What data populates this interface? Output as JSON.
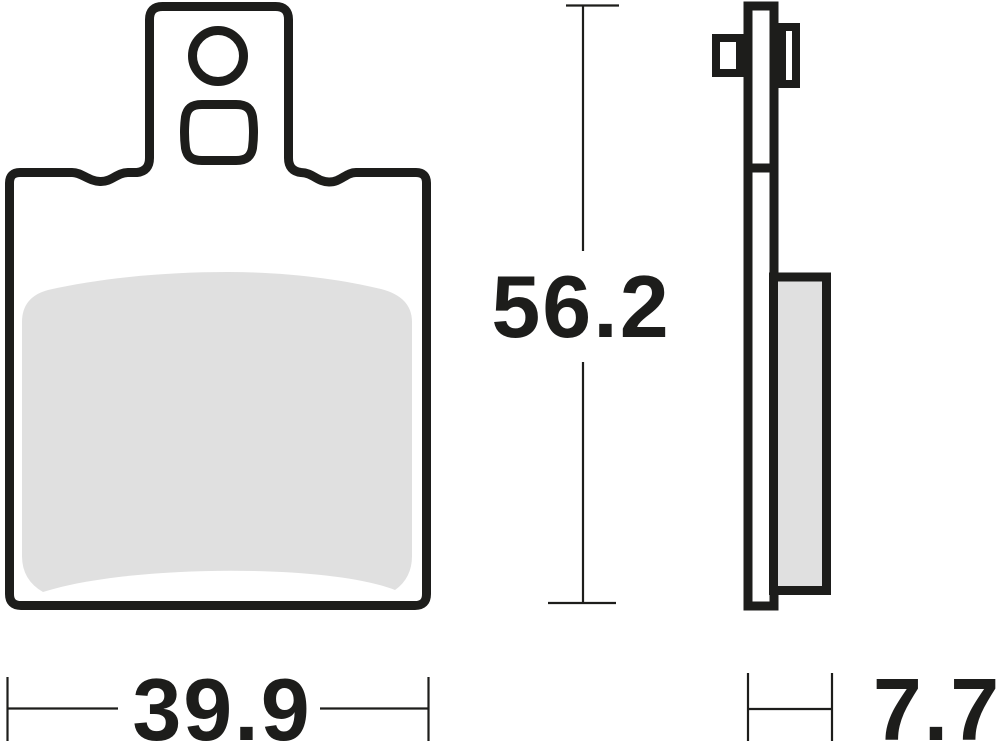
{
  "figure": {
    "kind": "brake-pad-technical-drawing",
    "dimensions": {
      "width": {
        "value": "39.9"
      },
      "height": {
        "value": "56.2"
      },
      "thickness": {
        "value": "7.7"
      }
    },
    "colors": {
      "line": "#1d1d1b",
      "friction": "#e0e0e0",
      "background": "#ffffff"
    }
  }
}
